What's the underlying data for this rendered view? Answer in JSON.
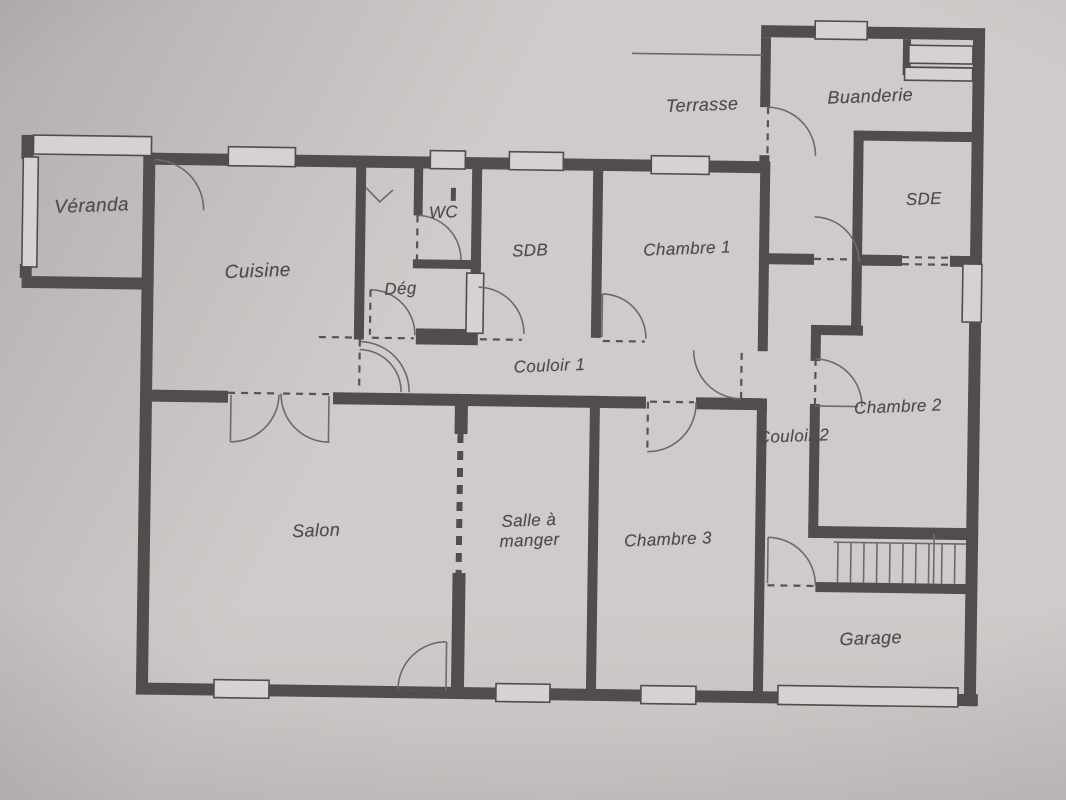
{
  "document_kind": "scanned house floor plan",
  "rooms": {
    "veranda": {
      "label": "Véranda"
    },
    "cuisine": {
      "label": "Cuisine"
    },
    "wc": {
      "label": "WC"
    },
    "deg": {
      "label": "Dég"
    },
    "sdb": {
      "label": "SDB"
    },
    "chambre1": {
      "label": "Chambre 1"
    },
    "terrasse": {
      "label": "Terrasse"
    },
    "buanderie": {
      "label": "Buanderie"
    },
    "sde": {
      "label": "SDE"
    },
    "couloir1": {
      "label": "Couloir 1"
    },
    "couloir2": {
      "label": "Couloir 2"
    },
    "chambre2": {
      "label": "Chambre 2"
    },
    "salon": {
      "label": "Salon"
    },
    "salle_a_manger": {
      "label": "Salle à\nmanger"
    },
    "chambre3": {
      "label": "Chambre 3"
    },
    "garage": {
      "label": "Garage"
    }
  },
  "colors": {
    "paper": "#cfcbca",
    "wall": "#514d4c",
    "line": "#6e6a69",
    "dash": "#575352",
    "text": "#4f4b4a"
  }
}
